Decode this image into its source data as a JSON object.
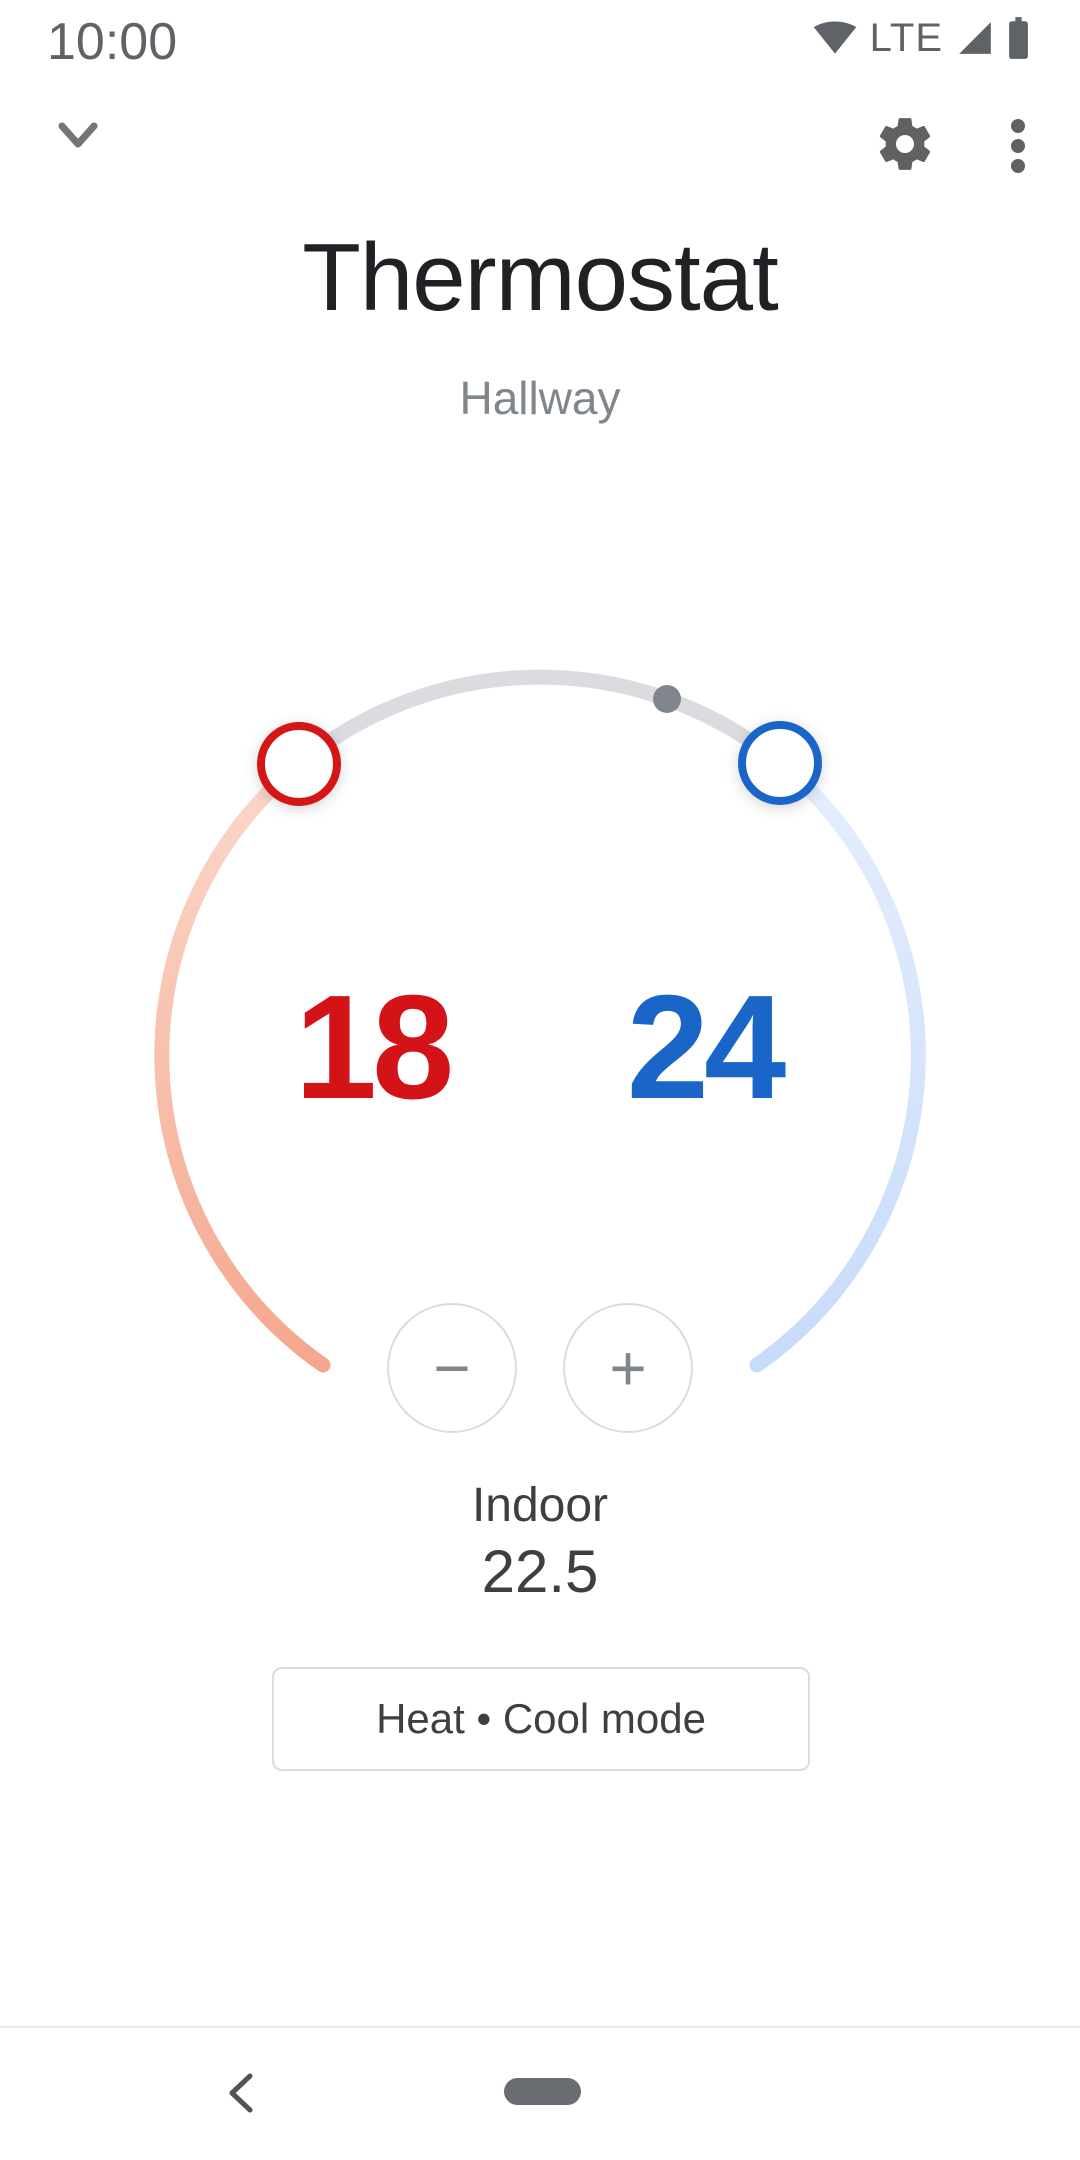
{
  "status_bar": {
    "time": "10:00",
    "network_type": "LTE",
    "icons": [
      "wifi-icon",
      "cell-signal-icon",
      "battery-icon"
    ]
  },
  "app_bar": {
    "collapse_icon": "chevron-down",
    "settings_icon": "gear",
    "overflow_icon": "three-dot-menu"
  },
  "header": {
    "title": "Thermostat",
    "room": "Hallway"
  },
  "dial": {
    "heat_setpoint": "18",
    "cool_setpoint": "24",
    "decrease_label": "−",
    "increase_label": "+",
    "colors": {
      "heat": "#d41318",
      "cool": "#1a65c8",
      "track": "#dadce0",
      "current_temp_dot": "#80868b",
      "heat_arc_start": "#fbd8cb",
      "heat_arc_end": "#f5a78d",
      "cool_arc_start": "#e4eefd",
      "cool_arc_end": "#c7dbfa"
    }
  },
  "readout": {
    "label": "Indoor",
    "value": "22.5"
  },
  "mode": {
    "label": "Heat • Cool mode"
  },
  "nav_bar": {
    "back_icon": "chevron-left",
    "home_icon": "gesture-pill"
  }
}
